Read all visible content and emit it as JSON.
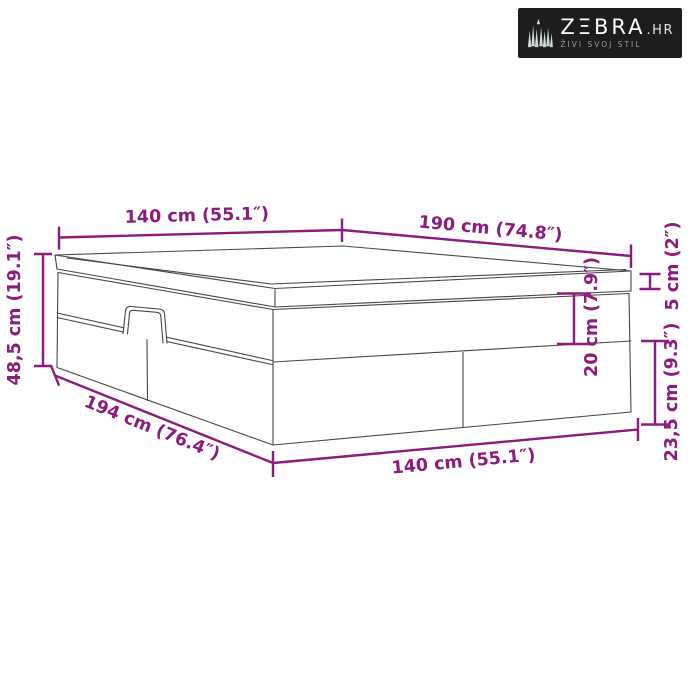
{
  "logo": {
    "brand": "ZΞBRA",
    "tld": ".HR",
    "tagline": "ŽIVI SVOJ STIL"
  },
  "dimensions": {
    "top_width": "140 cm (55.1″)",
    "length": "190 cm (74.8″)",
    "total_height": "48,5 cm (19.1″)",
    "base_length": "194 cm (76.4″)",
    "bottom_width": "140 cm (55.1″)",
    "mattress_thickness": "5 cm (2″)",
    "upper_section_height": "20 cm (7.9″)",
    "lower_section_height": "23,5 cm (9.3″)"
  },
  "colors": {
    "dimension_accent": "#8D1B7D",
    "drawing_outline": "#464646",
    "logo_background": "#1D1D1D",
    "page_background": "#FFFFFF"
  }
}
